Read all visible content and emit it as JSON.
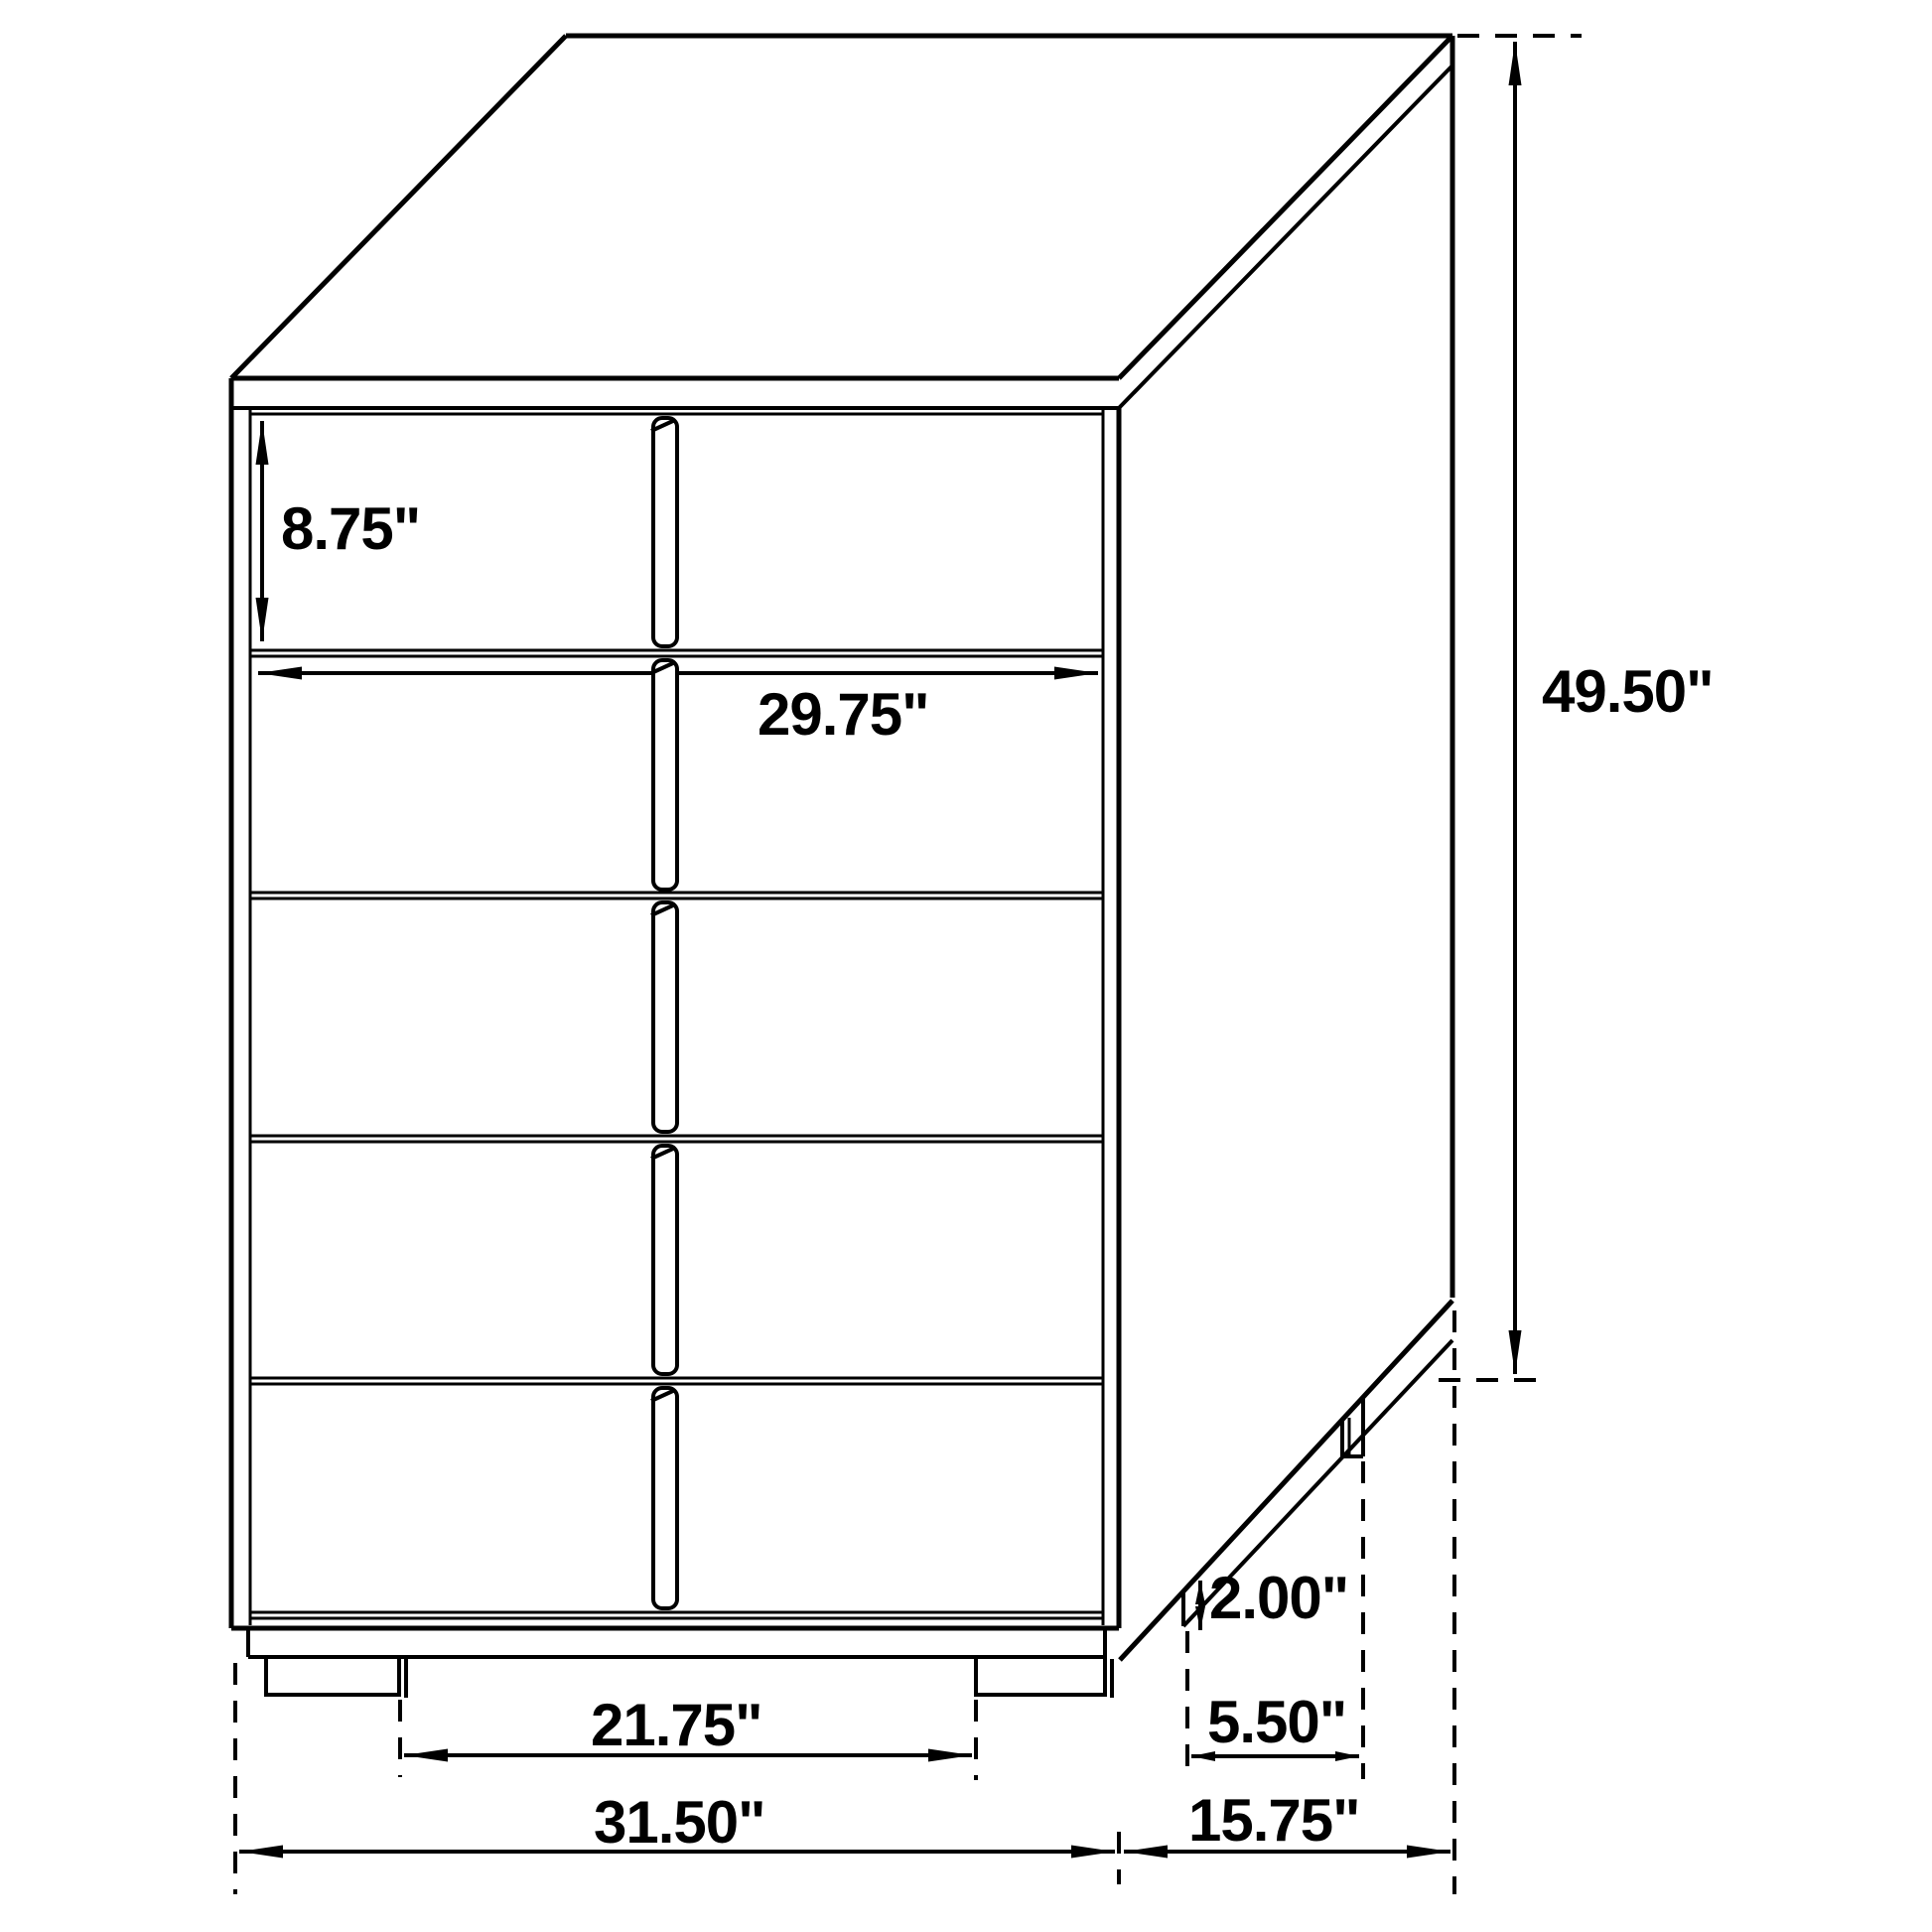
{
  "figure": {
    "type": "furniture-dimension-diagram",
    "subject": "five-drawer chest isometric line drawing",
    "units": "inches",
    "line_color": "#000000",
    "background_color": "#ffffff",
    "drawer_count": 5,
    "dimensions": {
      "drawer_height": "8.75\"",
      "drawer_front_width": "29.75\"",
      "overall_height": "49.50\"",
      "foot_height": "2.00\"",
      "side_foot_spacing": "5.50\"",
      "front_foot_spacing": "21.75\"",
      "overall_width": "31.50\"",
      "overall_depth": "15.75\""
    }
  }
}
